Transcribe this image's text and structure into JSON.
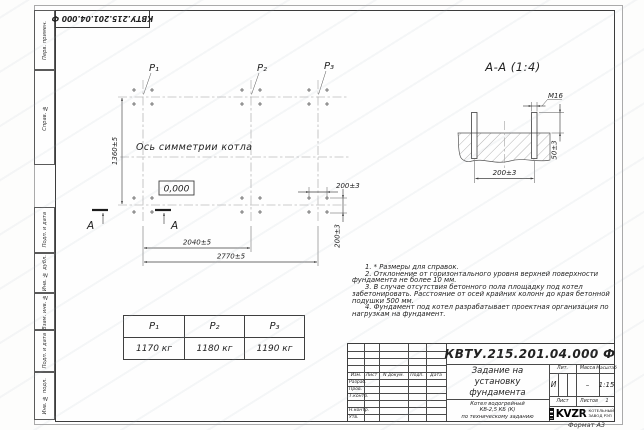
{
  "doc_number": "КВТУ.215.201.04.000 Ф",
  "format_label": "Формат А3",
  "sidebar": {
    "labels": [
      "Перв. примен.",
      "Справ. №",
      "Подп. и дата",
      "Инв. № дубл.",
      "Взам. инв. №",
      "Подп. и дата",
      "Инв. № подл."
    ]
  },
  "plan": {
    "p_labels": [
      "P₁",
      "P₂",
      "P₃"
    ],
    "axis_label": "Ось симметрии котла",
    "level_mark": "0,000",
    "dim_height": "1360±5",
    "dim_inner": "2040±5",
    "dim_outer": "2770±5",
    "dim_bolt_h": "200±3",
    "dim_bolt_v": "200±3",
    "section_letter": "А"
  },
  "section": {
    "title": "А-А (1:4)",
    "thread": "М16",
    "dim_protrusion": "50±3",
    "dim_spacing": "200±3"
  },
  "notes": [
    "1. * Размеры для справок.",
    "2. Отклонение от горизонтального уровня верхней поверхности фундамента не более 10 мм.",
    "3. В случае отсутствия бетонного пола площадку под котел забетонировать. Расстояние от осей крайних колонн до края бетонной подушки 500 мм.",
    "4. Фундамент под котел разрабатывает проектная организация по нагрузкам на фундамент."
  ],
  "load_table": {
    "headers": [
      "P₁",
      "P₂",
      "P₃"
    ],
    "values": [
      "1170 кг",
      "1180 кг",
      "1190 кг"
    ]
  },
  "title_block": {
    "doc_number": "КВТУ.215.201.04.000 Ф",
    "title_lines": [
      "Задание на",
      "установку",
      "фундамента"
    ],
    "product_lines": [
      "Котел водогрейный",
      "КВ-2,5 КБ (К)",
      "по техническому заданию"
    ],
    "col_headers": [
      "Изм.",
      "Лист",
      "N докум.",
      "Подп.",
      "Дата"
    ],
    "row_labels": [
      "Разраб.",
      "Пров.",
      "Т.контр.",
      "",
      "Н.контр.",
      "Утв."
    ],
    "lit_header": "Лит.",
    "mass_header": "Масса",
    "scale_header": "Масштаб",
    "lit_value": "И",
    "mass_value": "–",
    "scale_value": "1:15",
    "sheet_label": "Лист",
    "sheets_label": "Листов",
    "sheets_value": "1",
    "logo_text": "KVZR",
    "logo_lines": [
      "КОТЕЛЬНЫЙ",
      "ЗАВОД РЭП"
    ]
  }
}
